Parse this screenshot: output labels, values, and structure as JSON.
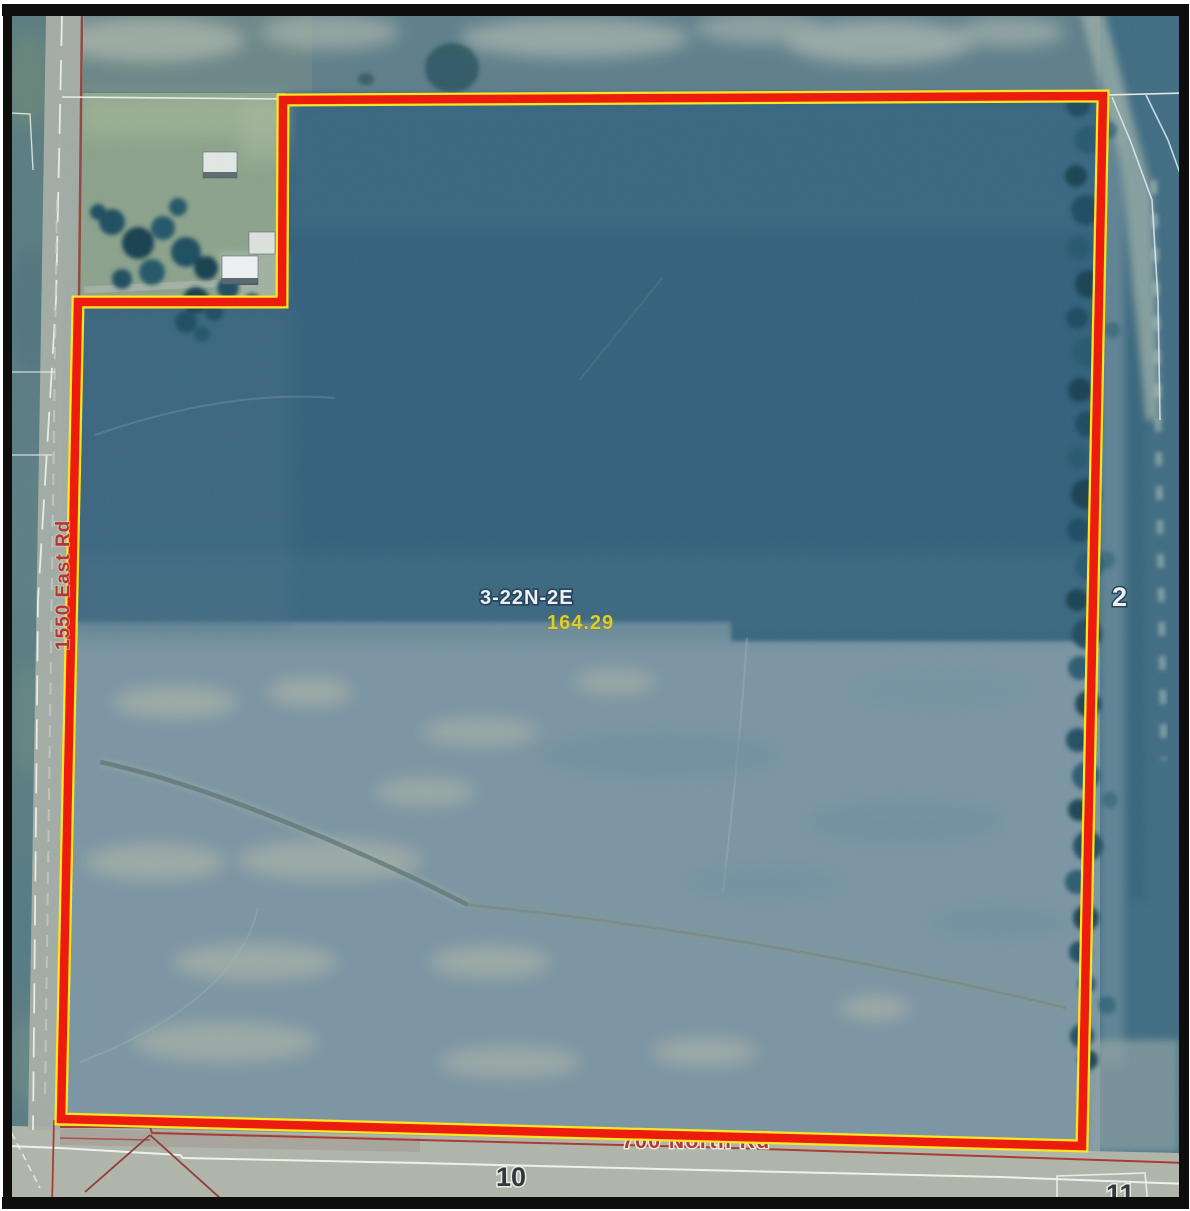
{
  "map": {
    "parcel": {
      "section_township_range": "3-22N-2E",
      "acres": "164.29"
    },
    "roads": {
      "west_label": "1550 East Rd",
      "south_label": "700 North Rd"
    },
    "sections": {
      "east": "2",
      "south": "10",
      "southeast": "11"
    },
    "colors": {
      "boundary_red": "#ee1608",
      "boundary_yellow": "#ffe81c",
      "acres_text": "#e0ce25",
      "road_label_red": "#b5332c",
      "section_text_light": "#eef2f4",
      "section_text_dark": "#2f3336"
    }
  }
}
